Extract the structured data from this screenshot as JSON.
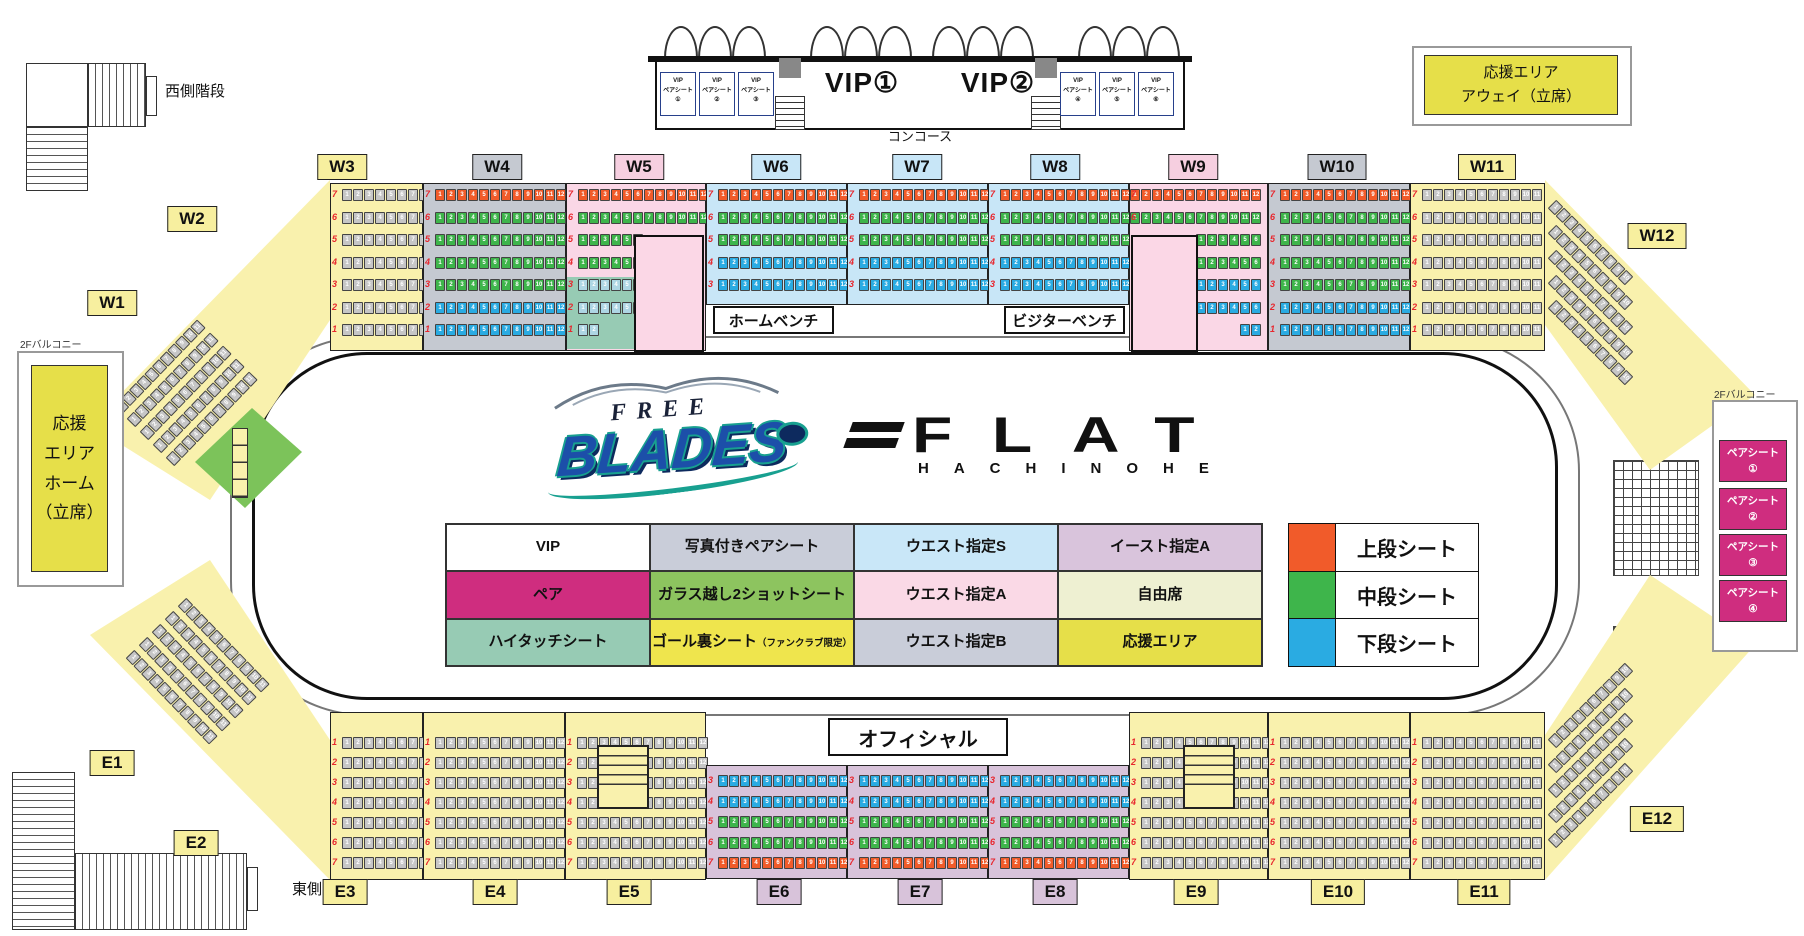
{
  "colors": {
    "badge_yellow": "#f7ef9f",
    "badge_pink": "#f6cfe0",
    "badge_blue": "#c8e6f7",
    "badge_gray": "#c5c9d1",
    "badge_mauve": "#d8c3da",
    "section_yellow": "#f9f1ad",
    "section_gray": "#c5c9d1",
    "section_pink": "#fad7e6",
    "section_blue": "#c8e6f7",
    "section_mauve": "#d8c3da",
    "mint": "#97cbb4",
    "magenta": "#cf2d7f",
    "glass_green": "#8dc45f",
    "free_pale": "#eef0d2",
    "goal_yellow": "#efe54d",
    "cheer_yellow": "#e6df49",
    "legend_gray": "#c9cdd9",
    "legend_blue": "#c9e7f8",
    "legend_mauve": "#d9c4dc",
    "legend_pink": "#fad9e6",
    "white": "#ffffff",
    "tier_orange": "#f15b2a",
    "tier_green": "#3eb54b",
    "tier_blue": "#2aabe2"
  },
  "seat_colors": {
    "orange": "#f15b2a",
    "green": "#3eb54b",
    "blue": "#2aabe2",
    "gray": "#c6c6c6",
    "pale": "#aed6e4"
  },
  "labels": {
    "west_stairs": "西側階段",
    "east_stairs": "東側階段",
    "balcony_left": "2Fバルコニー",
    "balcony_right": "2Fバルコニー",
    "concourse": "コンコース",
    "home_bench": "ホームベンチ",
    "visitor_bench": "ビジターベンチ",
    "official": "オフィシャル"
  },
  "standing": {
    "home_lines": [
      "応援",
      "エリア",
      "ホーム",
      "（立席）"
    ],
    "away_lines": [
      "応援エリア",
      "アウェイ（立席）"
    ]
  },
  "vip": {
    "room1": "VIP①",
    "room2": "VIP②",
    "left_booths": [
      {
        "l1": "VIP",
        "l2": "ペアシート",
        "l3": "①"
      },
      {
        "l1": "VIP",
        "l2": "ペアシート",
        "l3": "②"
      },
      {
        "l1": "VIP",
        "l2": "ペアシート",
        "l3": "③"
      }
    ],
    "right_booths": [
      {
        "l1": "VIP",
        "l2": "ペアシート",
        "l3": "④"
      },
      {
        "l1": "VIP",
        "l2": "ペアシート",
        "l3": "⑤"
      },
      {
        "l1": "VIP",
        "l2": "ペアシート",
        "l3": "⑥"
      }
    ]
  },
  "pair_seats": [
    {
      "l1": "ペアシート",
      "l2": "①"
    },
    {
      "l1": "ペアシート",
      "l2": "②"
    },
    {
      "l1": "ペアシート",
      "l2": "③"
    },
    {
      "l1": "ペアシート",
      "l2": "④"
    }
  ],
  "legend": {
    "grid": [
      [
        {
          "label": "VIP",
          "bg": "white"
        },
        {
          "label": "写真付きペアシート",
          "bg": "legend_gray"
        },
        {
          "label": "ウエスト指定S",
          "bg": "legend_blue"
        },
        {
          "label": "イースト指定A",
          "bg": "legend_mauve"
        }
      ],
      [
        {
          "label": "ペア",
          "bg": "magenta"
        },
        {
          "label": "ガラス越し2ショットシート",
          "bg": "glass_green"
        },
        {
          "label": "ウエスト指定A",
          "bg": "legend_pink"
        },
        {
          "label": "自由席",
          "bg": "free_pale"
        }
      ],
      [
        {
          "label": "ハイタッチシート",
          "bg": "mint"
        },
        {
          "label": "ゴール裏シート",
          "sub": "（ファンクラブ限定）",
          "bg": "goal_yellow"
        },
        {
          "label": "ウエスト指定B",
          "bg": "legend_gray"
        },
        {
          "label": "応援エリア",
          "bg": "cheer_yellow"
        }
      ]
    ],
    "tiers": [
      {
        "label": "上段シート",
        "bg": "tier_orange"
      },
      {
        "label": "中段シート",
        "bg": "tier_green"
      },
      {
        "label": "下段シート",
        "bg": "tier_blue"
      }
    ]
  },
  "logo_blades": {
    "top": "FREE",
    "main": "BLADES"
  },
  "logo_flat": {
    "main": "FLAT",
    "sub": "HACHINOHE"
  },
  "badges": [
    {
      "id": "W1",
      "label": "W1",
      "bg": "badge_yellow"
    },
    {
      "id": "W2",
      "label": "W2",
      "bg": "badge_yellow"
    },
    {
      "id": "W3",
      "label": "W3",
      "bg": "badge_yellow"
    },
    {
      "id": "W4",
      "label": "W4",
      "bg": "badge_gray"
    },
    {
      "id": "W5",
      "label": "W5",
      "bg": "badge_pink"
    },
    {
      "id": "W6",
      "label": "W6",
      "bg": "badge_blue"
    },
    {
      "id": "W7",
      "label": "W7",
      "bg": "badge_blue"
    },
    {
      "id": "W8",
      "label": "W8",
      "bg": "badge_blue"
    },
    {
      "id": "W9",
      "label": "W9",
      "bg": "badge_pink"
    },
    {
      "id": "W10",
      "label": "W10",
      "bg": "badge_gray"
    },
    {
      "id": "W11",
      "label": "W11",
      "bg": "badge_yellow"
    },
    {
      "id": "W12",
      "label": "W12",
      "bg": "badge_yellow"
    },
    {
      "id": "E1",
      "label": "E1",
      "bg": "badge_yellow"
    },
    {
      "id": "E2",
      "label": "E2",
      "bg": "badge_yellow"
    },
    {
      "id": "E3",
      "label": "E3",
      "bg": "badge_yellow"
    },
    {
      "id": "E4",
      "label": "E4",
      "bg": "badge_yellow"
    },
    {
      "id": "E5",
      "label": "E5",
      "bg": "badge_yellow"
    },
    {
      "id": "E6",
      "label": "E6",
      "bg": "badge_mauve"
    },
    {
      "id": "E7",
      "label": "E7",
      "bg": "badge_mauve"
    },
    {
      "id": "E8",
      "label": "E8",
      "bg": "badge_mauve"
    },
    {
      "id": "E9",
      "label": "E9",
      "bg": "badge_yellow"
    },
    {
      "id": "E10",
      "label": "E10",
      "bg": "badge_yellow"
    },
    {
      "id": "E11",
      "label": "E11",
      "bg": "badge_yellow"
    },
    {
      "id": "E12",
      "label": "E12",
      "bg": "badge_yellow"
    }
  ],
  "schemes": {
    "west_full": [
      [
        "7",
        "orange",
        12
      ],
      [
        "6",
        "green",
        12
      ],
      [
        "5",
        "green",
        12
      ],
      [
        "4",
        "green",
        12
      ],
      [
        "3",
        "green",
        12
      ],
      [
        "2",
        "blue",
        12
      ],
      [
        "1",
        "blue",
        12
      ]
    ],
    "west_s": [
      [
        "7",
        "orange",
        12
      ],
      [
        "6",
        "green",
        12
      ],
      [
        "5",
        "green",
        12
      ],
      [
        "4",
        "blue",
        12
      ],
      [
        "3",
        "blue",
        12
      ]
    ],
    "west_a": [
      [
        "7",
        "orange",
        12
      ],
      [
        "6",
        "green",
        12
      ],
      [
        "5",
        "green",
        6
      ],
      [
        "4",
        "green",
        6
      ],
      [
        "3",
        "pale",
        6
      ],
      [
        "2",
        "pale",
        6
      ],
      [
        "1",
        "pale",
        2
      ]
    ],
    "west_a9": [
      [
        "7",
        "orange",
        12
      ],
      [
        "6",
        "green",
        12
      ],
      [
        "5",
        "green",
        6
      ],
      [
        "4",
        "green",
        6
      ],
      [
        "3",
        "blue",
        6
      ],
      [
        "2",
        "blue",
        6
      ],
      [
        "1",
        "blue",
        2
      ]
    ],
    "east_a": [
      [
        "3",
        "blue",
        12
      ],
      [
        "4",
        "blue",
        12
      ],
      [
        "5",
        "green",
        12
      ],
      [
        "6",
        "green",
        12
      ],
      [
        "7",
        "orange",
        12
      ]
    ],
    "yellow_top": [
      [
        "7",
        "gray",
        0
      ],
      [
        "6",
        "gray",
        0
      ],
      [
        "5",
        "gray",
        0
      ],
      [
        "4",
        "gray",
        0
      ],
      [
        "3",
        "gray",
        0
      ],
      [
        "2",
        "gray",
        0
      ],
      [
        "1",
        "gray",
        0
      ]
    ],
    "yellow_bottom": [
      [
        "1",
        "gray",
        0
      ],
      [
        "2",
        "gray",
        0
      ],
      [
        "3",
        "gray",
        0
      ],
      [
        "4",
        "gray",
        0
      ],
      [
        "5",
        "gray",
        0
      ],
      [
        "6",
        "gray",
        0
      ],
      [
        "7",
        "gray",
        0
      ]
    ]
  },
  "sections": [
    {
      "id": "W3",
      "scheme": "yellow_top",
      "bg": "section_yellow",
      "seats": 8
    },
    {
      "id": "W4",
      "scheme": "west_full",
      "bg": "section_gray",
      "seats": 12
    },
    {
      "id": "W5",
      "scheme": "west_a",
      "bg": "section_pink",
      "seats": 12
    },
    {
      "id": "W6",
      "scheme": "west_s",
      "bg": "section_blue",
      "seats": 12
    },
    {
      "id": "W7",
      "scheme": "west_s",
      "bg": "section_blue",
      "seats": 12
    },
    {
      "id": "W8",
      "scheme": "west_s",
      "bg": "section_blue",
      "seats": 12
    },
    {
      "id": "W9",
      "scheme": "west_a9",
      "bg": "section_pink",
      "seats": 12
    },
    {
      "id": "W10",
      "scheme": "west_full",
      "bg": "section_gray",
      "seats": 12
    },
    {
      "id": "W11",
      "scheme": "yellow_top",
      "bg": "section_yellow",
      "seats": 11
    },
    {
      "id": "E3",
      "scheme": "yellow_bottom",
      "bg": "section_yellow",
      "seats": 8
    },
    {
      "id": "E4",
      "scheme": "yellow_bottom",
      "bg": "section_yellow",
      "seats": 12
    },
    {
      "id": "E5",
      "scheme": "yellow_bottom",
      "bg": "section_yellow",
      "seats": 12
    },
    {
      "id": "E6",
      "scheme": "east_a",
      "bg": "section_mauve",
      "seats": 12
    },
    {
      "id": "E7",
      "scheme": "east_a",
      "bg": "section_mauve",
      "seats": 12
    },
    {
      "id": "E8",
      "scheme": "east_a",
      "bg": "section_mauve",
      "seats": 12
    },
    {
      "id": "E9",
      "scheme": "yellow_bottom",
      "bg": "section_yellow",
      "seats": 12
    },
    {
      "id": "E10",
      "scheme": "yellow_bottom",
      "bg": "section_yellow",
      "seats": 12
    },
    {
      "id": "E11",
      "scheme": "yellow_bottom",
      "bg": "section_yellow",
      "seats": 11
    }
  ],
  "corners": [
    {
      "id": "tl"
    },
    {
      "id": "tr"
    },
    {
      "id": "bl"
    },
    {
      "id": "br"
    }
  ],
  "seat_numbers_max": 12,
  "row_numbers": [
    "1",
    "2",
    "3",
    "4",
    "5",
    "6",
    "7"
  ]
}
